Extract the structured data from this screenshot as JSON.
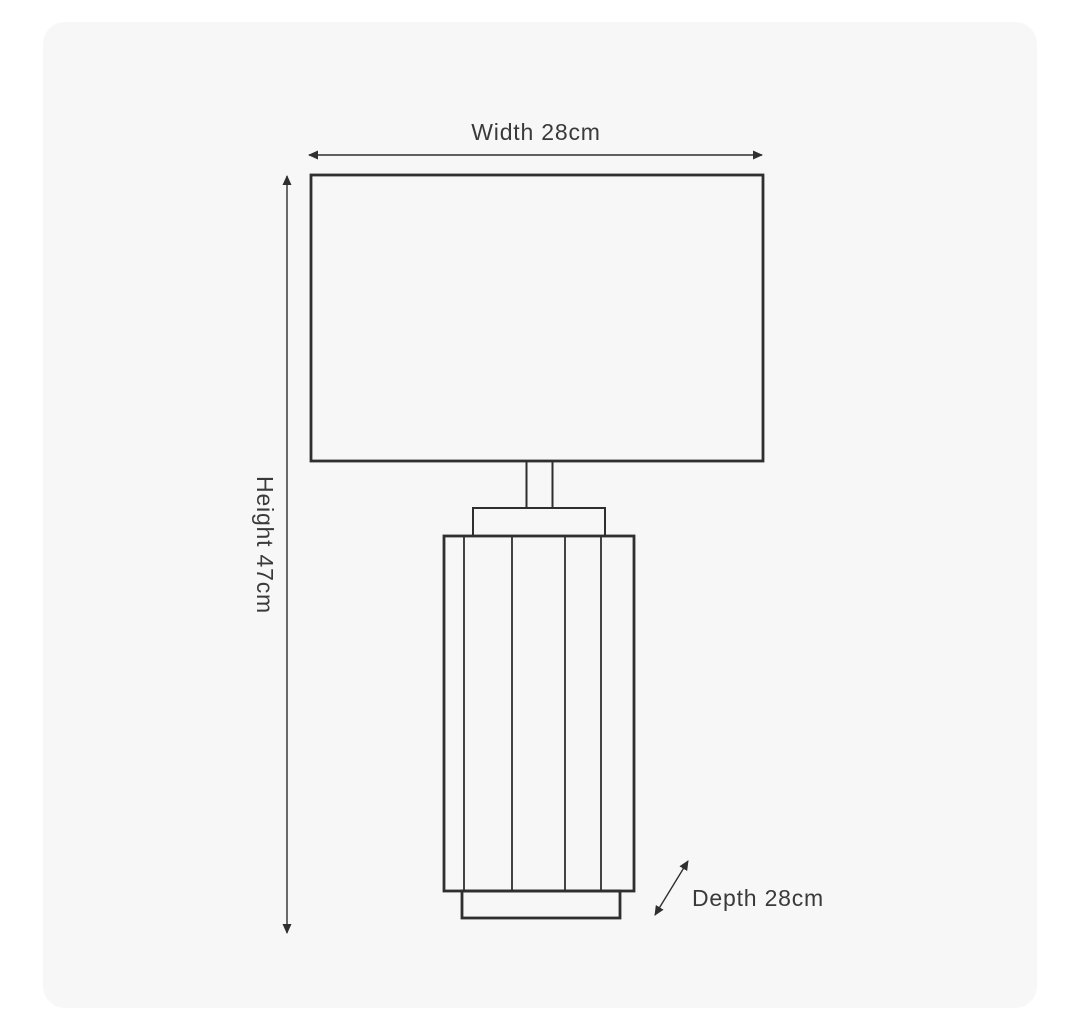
{
  "colors": {
    "page-bg": "#ffffff",
    "card-bg": "#f7f7f7",
    "line": "#2f2f2f",
    "label": "#3a3a3a"
  },
  "diagram": {
    "type": "product-dimension-diagram",
    "subject": "table lamp with rectangular shade and slatted column base",
    "dimensions": {
      "width": {
        "name": "Width",
        "value": 28,
        "unit": "cm",
        "label": "Width 28cm"
      },
      "height": {
        "name": "Height",
        "value": 47,
        "unit": "cm",
        "label": "Height 47cm"
      },
      "depth": {
        "name": "Depth",
        "value": 28,
        "unit": "cm",
        "label": "Depth 28cm"
      }
    }
  }
}
